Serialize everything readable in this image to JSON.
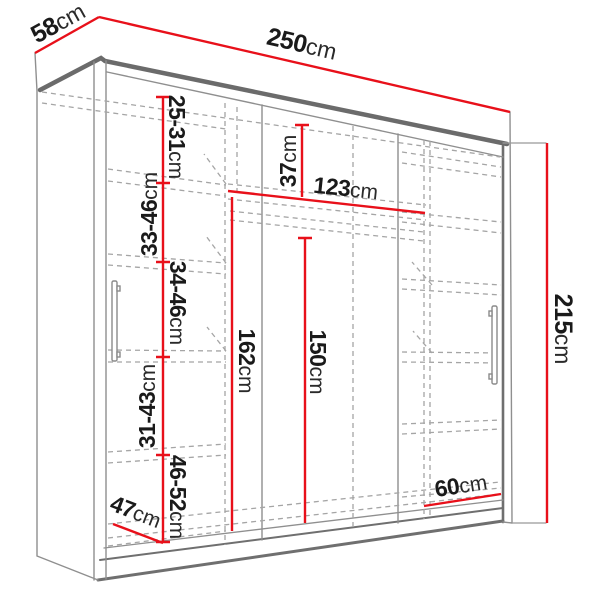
{
  "drawing": {
    "subject": "wardrobe-technical-dimension-diagram",
    "colors": {
      "dimension_line": "#e8101a",
      "edge_dark": "#6b6b6b",
      "edge_light": "#8f8f8f",
      "hidden_dashed": "#a5a5a5",
      "label_text": "#1a1a1a",
      "background": "#ffffff"
    }
  },
  "dimensions": {
    "depth": {
      "value": "58",
      "unit": "cm"
    },
    "width": {
      "value": "250",
      "unit": "cm"
    },
    "height": {
      "value": "215",
      "unit": "cm"
    },
    "shelf_gap_1": {
      "value": "25-31",
      "unit": "cm"
    },
    "shelf_gap_2": {
      "value": "33-46",
      "unit": "cm"
    },
    "shelf_gap_3": {
      "value": "34-46",
      "unit": "cm"
    },
    "shelf_gap_4": {
      "value": "31-43",
      "unit": "cm"
    },
    "shelf_gap_5": {
      "value": "46-52",
      "unit": "cm"
    },
    "top_shelf": {
      "value": "37",
      "unit": "cm"
    },
    "middle_width": {
      "value": "123",
      "unit": "cm"
    },
    "hanging_left": {
      "value": "162",
      "unit": "cm"
    },
    "hanging_right": {
      "value": "150",
      "unit": "cm"
    },
    "right_width": {
      "value": "60",
      "unit": "cm"
    },
    "bottom_depth": {
      "value": "47",
      "unit": "cm"
    }
  }
}
